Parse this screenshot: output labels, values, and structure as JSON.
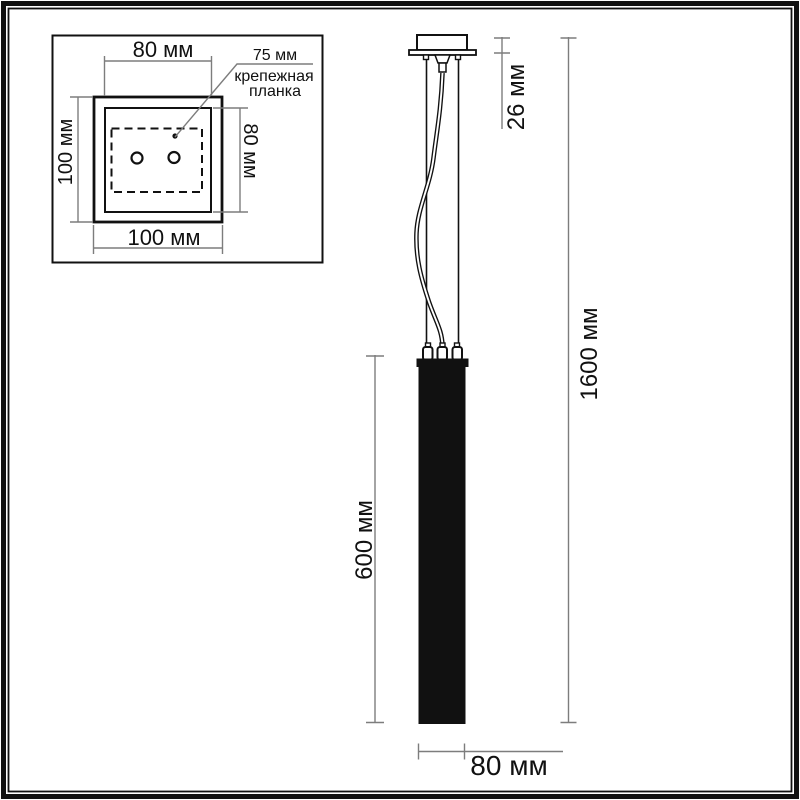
{
  "inset": {
    "top_dim": "80 мм",
    "left_dim": "100 мм",
    "right_dim": "80 мм",
    "bottom_dim": "100 мм",
    "callout": {
      "value": "75 мм",
      "label_line1": "крепежная",
      "label_line2": "планка"
    }
  },
  "main": {
    "canopy_depth": "26 мм",
    "total_height": "1600 мм",
    "shade_height": "600 мм",
    "shade_width": "80 мм"
  },
  "colors": {
    "ink": "#111111",
    "dim_line": "#7d7d7d",
    "background": "#ffffff"
  }
}
